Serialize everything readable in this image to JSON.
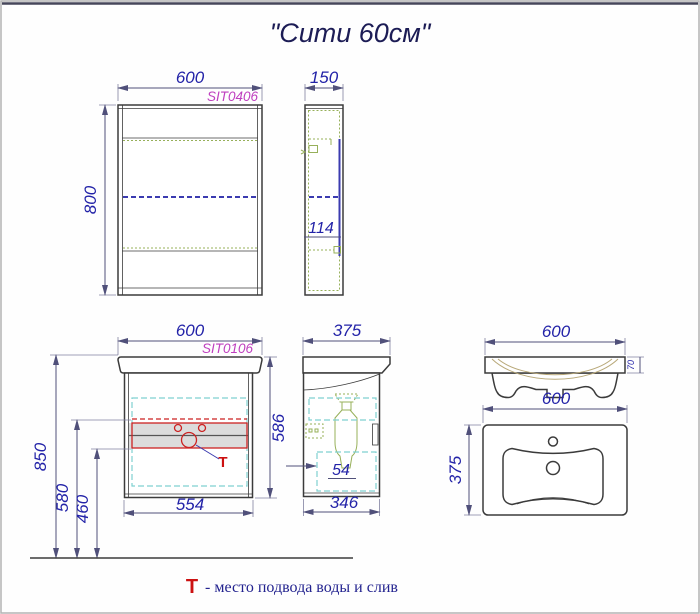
{
  "title": "\"Сити 60см\"",
  "colors": {
    "dimension_text": "#2323a8",
    "dimension_line": "#50507a",
    "drawing_line": "#3b3b3b",
    "product_code": "#bf3fbf",
    "shelf_green": "#97b05a",
    "door_cyan": "#7fd0d0",
    "mirror_blue": "#3b3bb0",
    "supply_red": "#cc2222"
  },
  "mirror_front": {
    "code": "SIT0406",
    "width": "600",
    "height": "800"
  },
  "mirror_side": {
    "width": "150",
    "inner_depth": "114"
  },
  "vanity_front": {
    "code": "SIT0106",
    "width": "600",
    "height": "586",
    "bottom_width": "554",
    "mount_height": "850",
    "supply_top": "580",
    "supply_bottom": "460",
    "supply_symbol": "T"
  },
  "vanity_side": {
    "width": "375",
    "bottom_depth": "346",
    "clearance": "54"
  },
  "sink_front": {
    "width": "600",
    "rim_height": "70"
  },
  "sink_top": {
    "width": "600",
    "depth": "375"
  },
  "legend": {
    "symbol": "T",
    "text": "- место подвода воды и слив"
  }
}
